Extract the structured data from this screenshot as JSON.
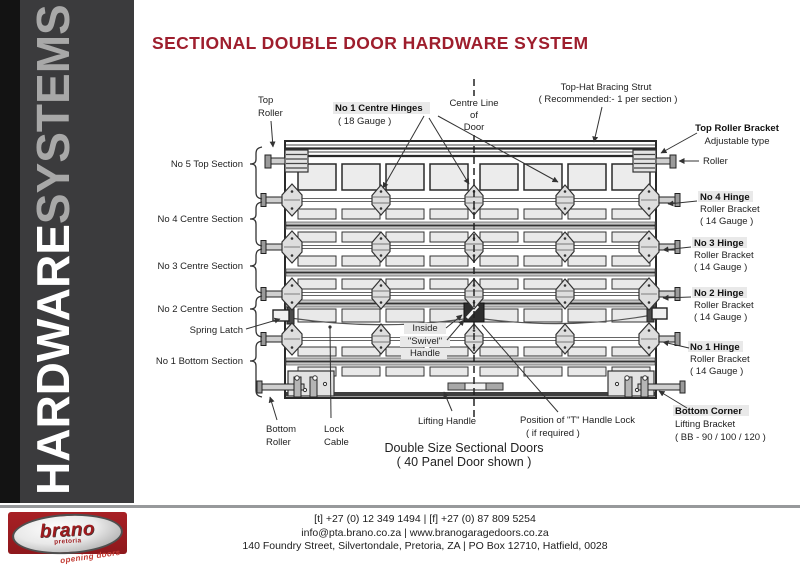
{
  "title": "SECTIONAL DOUBLE DOOR HARDWARE SYSTEM",
  "colors": {
    "accent_red": "#9E1E2D",
    "sidebar_gray": "#3B3B3D",
    "logo_red": "#9E1B1E"
  },
  "sidebar": {
    "word1": "HARDWARE",
    "word2": "SYSTEMS"
  },
  "logo": {
    "name": "brano",
    "subtitle": "pretoria",
    "tagline": "opening doors"
  },
  "diagram": {
    "top_roller": {
      "l1": "Top",
      "l2": "Roller"
    },
    "centre_hinges": {
      "title": "No 1 Centre Hinges",
      "sub": "( 18 Gauge )"
    },
    "centre_line": {
      "l1": "Centre Line",
      "l2": "of",
      "l3": "Door"
    },
    "strut": {
      "title": "Top-Hat Bracing Strut",
      "sub": "( Recommended:- 1 per section )"
    },
    "top_roller_bracket": {
      "title": "Top Roller Bracket",
      "sub": "Adjustable type"
    },
    "roller": "Roller",
    "hinge4": {
      "title": "No 4 Hinge",
      "l2": "Roller Bracket",
      "l3": "( 14 Gauge )"
    },
    "hinge3": {
      "title": "No 3 Hinge",
      "l2": "Roller Bracket",
      "l3": "( 14 Gauge )"
    },
    "hinge2": {
      "title": "No 2 Hinge",
      "l2": "Roller Bracket",
      "l3": "( 14 Gauge )"
    },
    "hinge1": {
      "title": "No 1 Hinge",
      "l2": "Roller Bracket",
      "l3": "( 14 Gauge )"
    },
    "bottom_corner": {
      "title": "Bottom Corner",
      "l2": "Lifting Bracket",
      "l3": "( BB - 90 / 100 / 120 )"
    },
    "sec5": "No 5 Top Section",
    "sec4": "No 4 Centre Section",
    "sec3": "No 3 Centre Section",
    "sec2": "No 2 Centre Section",
    "sec1": "No 1 Bottom Section",
    "spring_latch": "Spring Latch",
    "swivel": {
      "l1": "Inside",
      "l2": "\"Swivel\"",
      "l3": "Handle"
    },
    "bottom_roller": {
      "l1": "Bottom",
      "l2": "Roller"
    },
    "lock_cable": {
      "l1": "Lock",
      "l2": "Cable"
    },
    "lifting_handle": "Lifting Handle",
    "t_handle": {
      "l1": "Position of \"T\" Handle Lock",
      "l2": "( if required )"
    },
    "caption": {
      "l1": "Double Size Sectional Doors",
      "l2": "( 40 Panel Door shown )"
    }
  },
  "footer": {
    "line1": "[t]  +27 (0) 12 349 1494   |   [f]  +27 (0) 87 809 5254",
    "line2": "info@pta.brano.co.za   |   www.branogaragedoors.co.za",
    "line3": "140 Foundry Street, Silvertondale, Pretoria, ZA   |   PO Box 12710, Hatfield, 0028"
  }
}
